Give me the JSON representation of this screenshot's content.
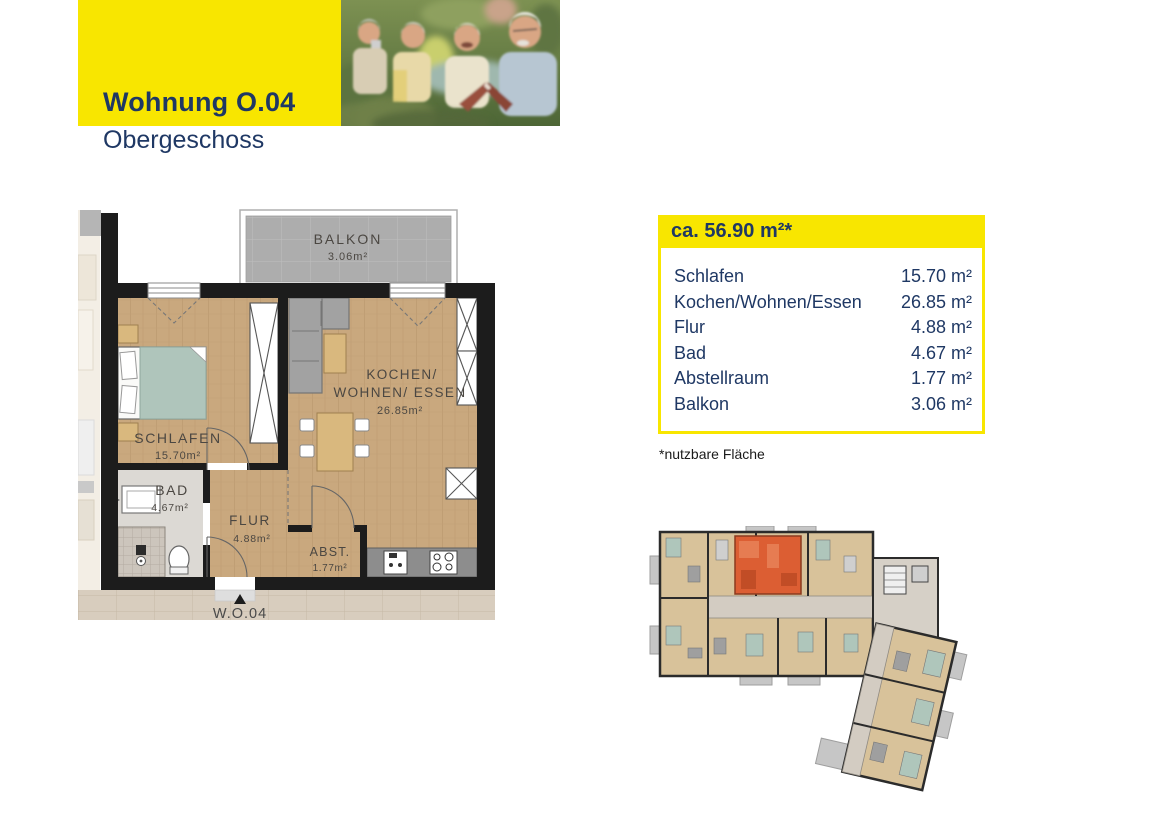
{
  "header": {
    "title": "Wohnung O.04",
    "subtitle": "Obergeschoss"
  },
  "photo": {
    "description": "seniors-reading-outdoors"
  },
  "info_box": {
    "total_area": "ca. 56.90 m²*",
    "rows": [
      {
        "label": "Schlafen",
        "value": "15.70 m²"
      },
      {
        "label": "Kochen/Wohnen/Essen",
        "value": "26.85 m²"
      },
      {
        "label": "Flur",
        "value": "4.88 m²"
      },
      {
        "label": "Bad",
        "value": "4.67 m²"
      },
      {
        "label": "Abstellraum",
        "value": "1.77 m²"
      },
      {
        "label": "Balkon",
        "value": "3.06 m²"
      }
    ],
    "footnote": "*nutzbare Fläche"
  },
  "floorplan": {
    "balkon": {
      "name": "BALKON",
      "area": "3.06m²"
    },
    "schlafen": {
      "name": "SCHLAFEN",
      "area": "15.70m²"
    },
    "kochen": {
      "line1": "KOCHEN/",
      "line2": "WOHNEN/ ESSEN",
      "area": "26.85m²"
    },
    "bad": {
      "name": "BAD",
      "area": "4.67m²"
    },
    "flur": {
      "name": "FLUR",
      "area": "4.88m²"
    },
    "abst": {
      "name": "ABST.",
      "area": "1.77m²"
    },
    "entrance": "W.O.04"
  },
  "colors": {
    "accent_yellow": "#F8E600",
    "navy": "#1F3864",
    "highlight_orange": "#DC5E33",
    "wall_black": "#1C1C1C",
    "wood_floor": "#C9A87E"
  }
}
